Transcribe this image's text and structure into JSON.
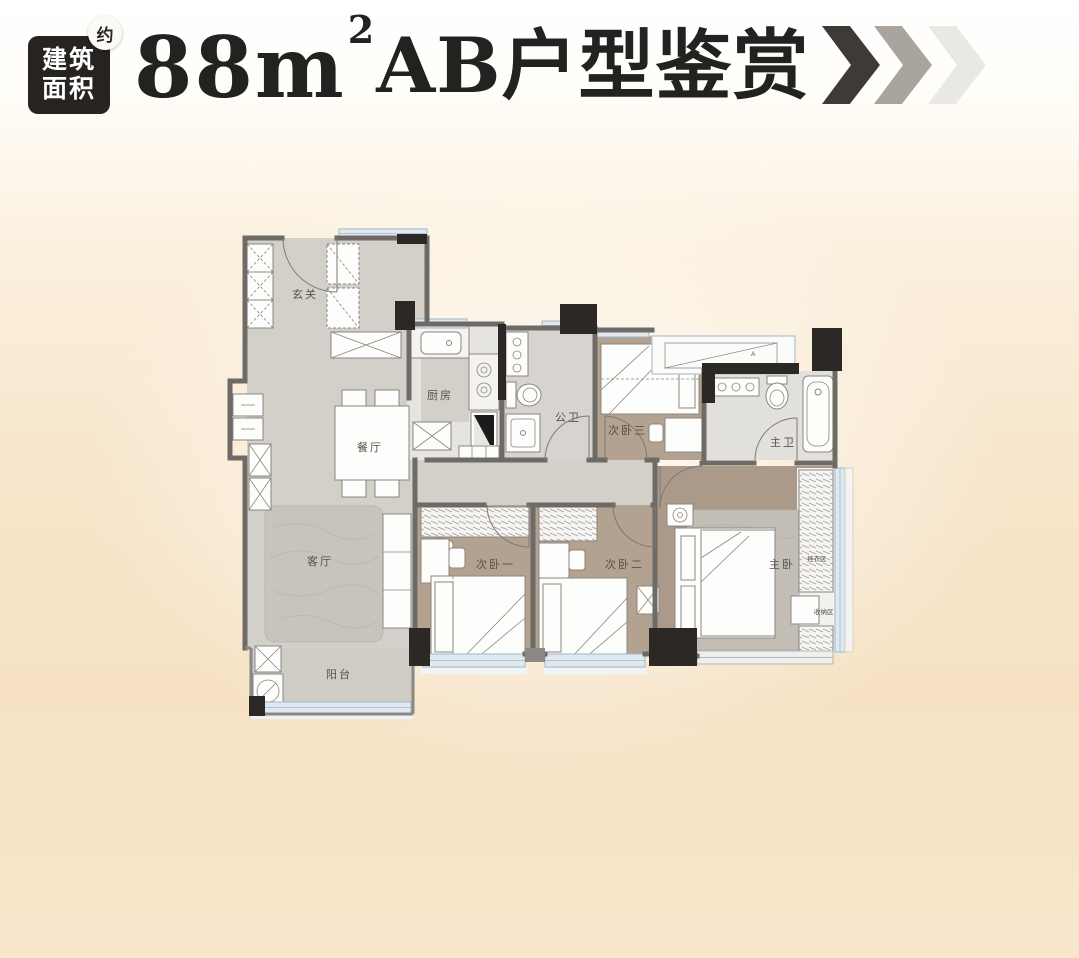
{
  "header": {
    "badge": {
      "line1": "建筑",
      "line2": "面积",
      "approx": "约",
      "bg": "#262321",
      "text_color": "#ffffff"
    },
    "title": {
      "area_number": "88",
      "area_unit": "m",
      "area_sup": "2",
      "suffix": "AB户型鉴赏",
      "color": "#242220"
    },
    "chevron_colors": [
      "#3d3a37",
      "#a9a49d",
      "#eae8e5"
    ]
  },
  "plan": {
    "labels": [
      {
        "text": "玄关"
      },
      {
        "text": "厨房"
      },
      {
        "text": "餐厅"
      },
      {
        "text": "公卫"
      },
      {
        "text": "次卧三"
      },
      {
        "text": "主卫"
      },
      {
        "text": "客厅"
      },
      {
        "text": "次卧一"
      },
      {
        "text": "次卧二"
      },
      {
        "text": "主卧"
      },
      {
        "text": "阳台"
      },
      {
        "text": "挂衣区"
      },
      {
        "text": "收纳区"
      },
      {
        "text": "A"
      }
    ],
    "colors": {
      "wall": "#6e6a66",
      "column": "#2b2826",
      "floor_gray": "#d3d0ca",
      "floor_wood": "#b3a290",
      "glazing": "#dfe9ef",
      "background_peach": "#f6e1c3"
    }
  }
}
